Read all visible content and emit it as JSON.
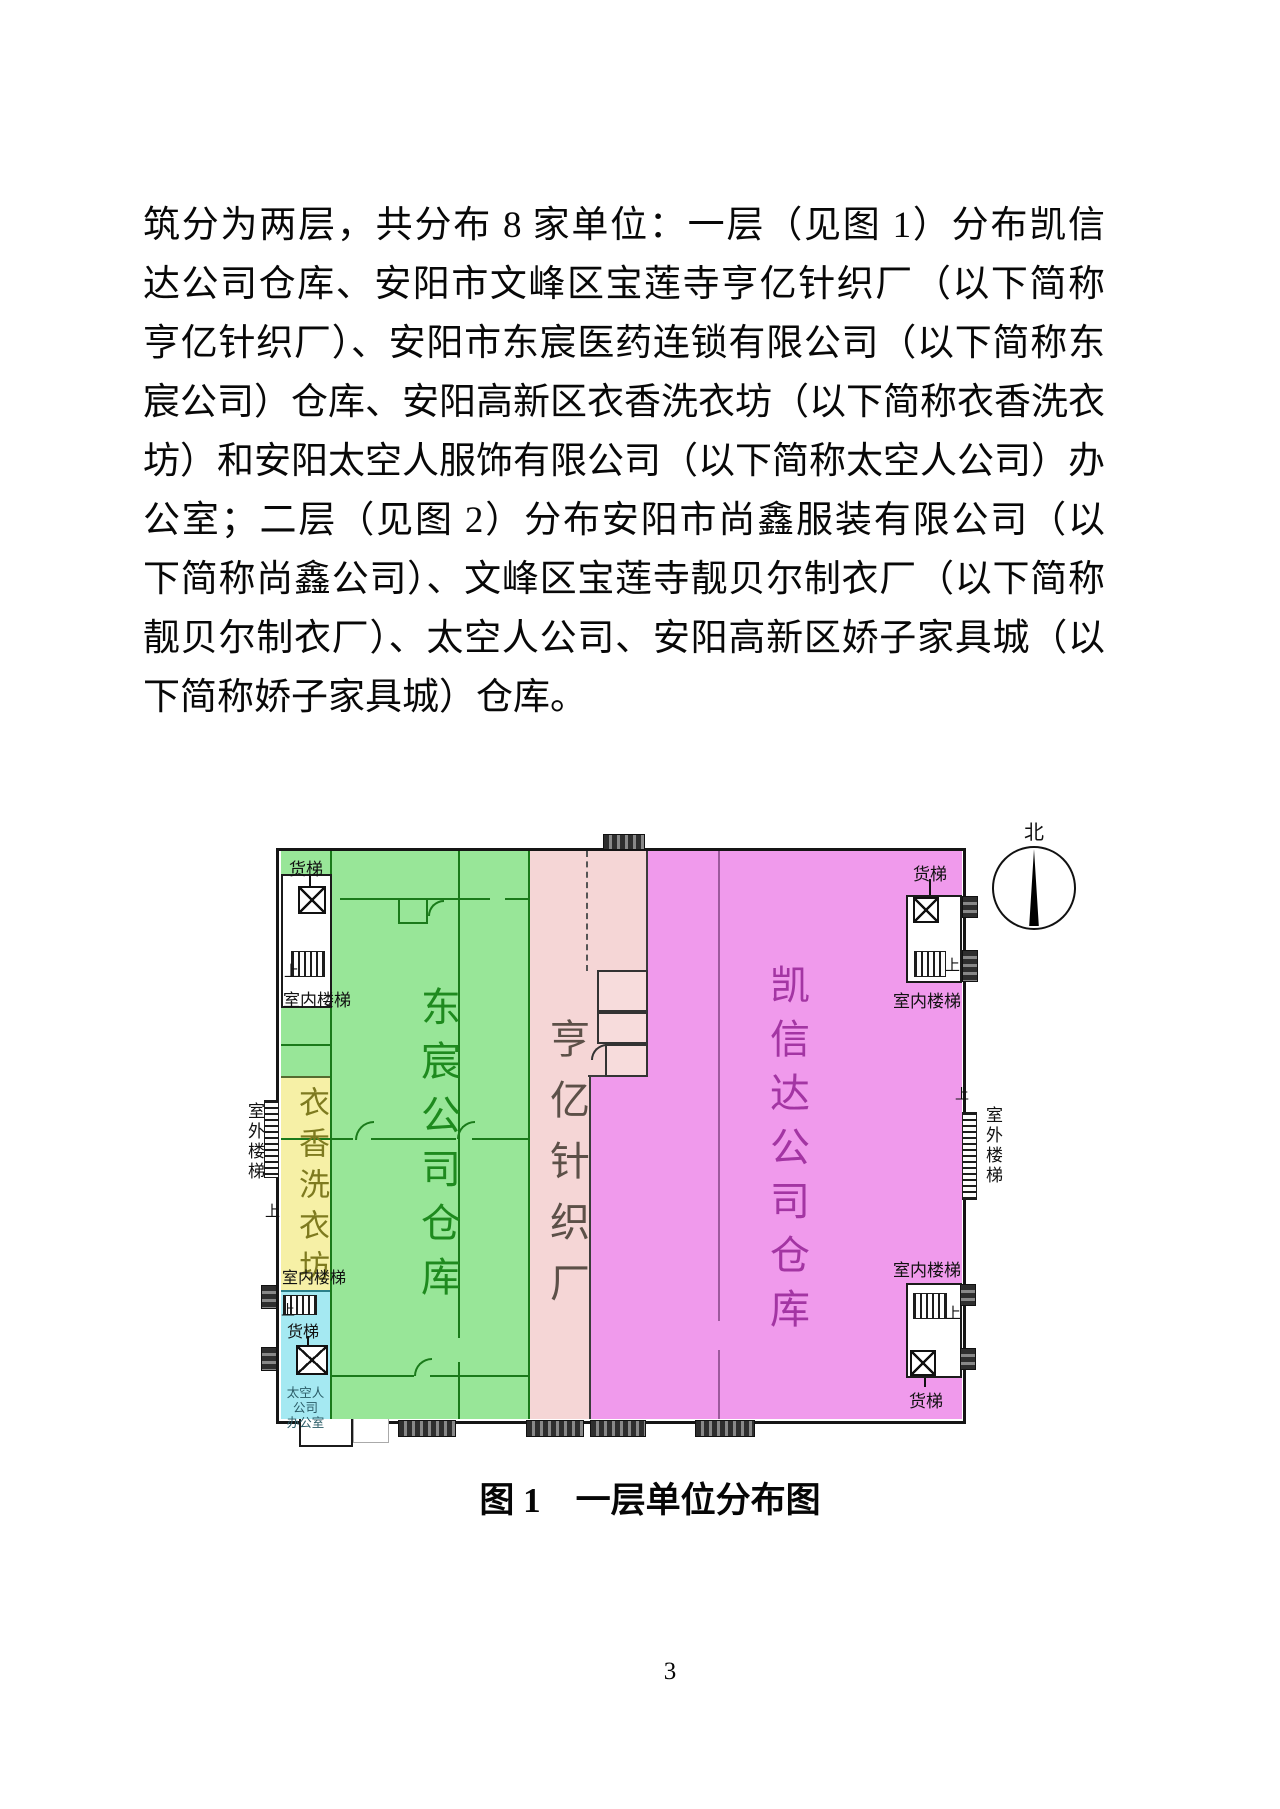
{
  "page": {
    "number": "3"
  },
  "paragraph": {
    "lines": [
      "筑分为两层，共分布 8 家单位：一层（见图 1）分布凯信",
      "达公司仓库、安阳市文峰区宝莲寺亨亿针织厂（以下简称",
      "亨亿针织厂）、安阳市东宸医药连锁有限公司（以下简称东",
      "宸公司）仓库、安阳高新区衣香洗衣坊（以下简称衣香洗衣",
      "坊）和安阳太空人服饰有限公司（以下简称太空人公司）办",
      "公室；二层（见图 2）分布安阳市尚鑫服装有限公司（以",
      "下简称尚鑫公司）、文峰区宝莲寺靓贝尔制衣厂（以下简称",
      "靓贝尔制衣厂）、太空人公司、安阳高新区娇子家具城（以",
      "下简称娇子家具城）仓库。"
    ]
  },
  "figure": {
    "caption": "图 1　一层单位分布图",
    "compass_north": "北",
    "regions": {
      "dongchen": {
        "name": "东宸公司仓库",
        "fill": "#98e698",
        "label_color": "#1e8a1e"
      },
      "hengyi": {
        "name": "亨亿针织厂",
        "fill": "#f5d6d6",
        "label_color": "#5c5048"
      },
      "kaixinda": {
        "name": "凯信达公司仓库",
        "fill": "#f09aec",
        "label_color": "#a335a3"
      },
      "yixiang": {
        "name": "衣香洗衣坊",
        "fill": "#f6f0a6",
        "label_color": "#7e7a1f"
      },
      "taikongren": {
        "name_line1": "太空人公司",
        "name_line2": "办公室",
        "fill": "#a5e9f2",
        "label_color": "#2a5b66"
      }
    },
    "annotations": {
      "freight_elevator": "货梯",
      "indoor_stairs": "室内楼梯",
      "outdoor_stairs": "室外楼梯",
      "up": "上"
    }
  }
}
